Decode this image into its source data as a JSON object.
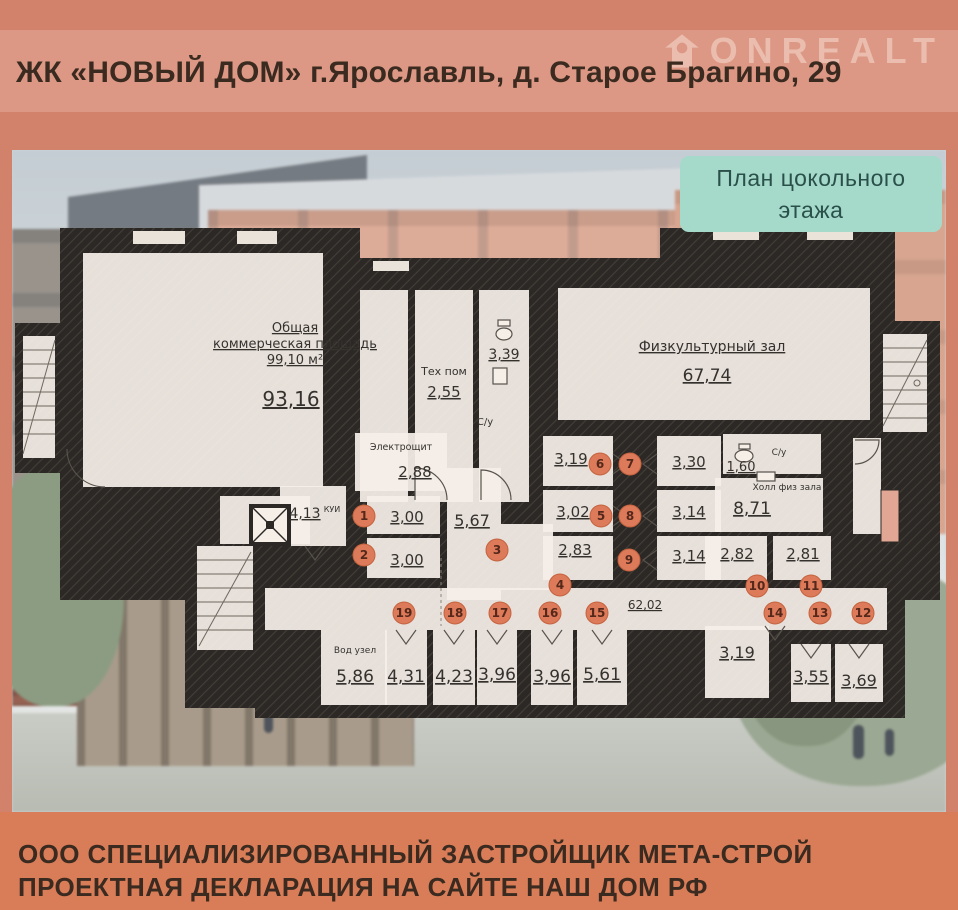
{
  "header": {
    "title": "ЖК «НОВЫЙ ДОМ» г.Ярославль, д. Старое Брагино, 29",
    "watermark": "ONREALT"
  },
  "badge": {
    "line1": "План цокольного",
    "line2": "этажа"
  },
  "footer": {
    "text": "ООО СПЕЦИАЛИЗИРОВАННЫЙ ЗАСТРОЙЩИК МЕТА-СТРОЙ ПРОЕКТНАЯ ДЕКЛАРАЦИЯ НА САЙТЕ НАШ ДОМ РФ"
  },
  "colors": {
    "background": "#d2826b",
    "footer_band": "#d87d58",
    "badge": "#a5dacb",
    "walls": "#2c2825",
    "room_fill": "#f5efe8",
    "marker": "#dd7a5a"
  },
  "rooms": {
    "commercial_name1": "Общая",
    "commercial_name2": "коммерческая площадь",
    "commercial_size": "99,10 м²",
    "commercial_area": "93,16",
    "tech_name": "Тех пом",
    "tech_area": "2,55",
    "wc1_area": "3,39",
    "wc1_name": "С/у",
    "gym_name": "Физкультурный зал",
    "gym_area": "67,74",
    "electro_name": "Электрощит",
    "electro_area": "2,88",
    "kui_area": "4,13",
    "kui_name": "КУИ",
    "r1": "3,00",
    "r2": "3,00",
    "hall1": "5,67",
    "r4": "2,83",
    "r5": "3,02",
    "r6": "3,19",
    "r7": "3,30",
    "r8": "3,14",
    "r9": "3,14",
    "wc2_area": "1,60",
    "wc2_name": "С/у",
    "hall2_name": "Холл физ зала",
    "hall2_area": "8,71",
    "r10": "2,82",
    "r11": "2,81",
    "vod_name": "Вод узел",
    "vod_area": "5,86",
    "r19": "4,31",
    "r18": "4,23",
    "r17": "3,96",
    "r16": "3,96",
    "r15": "5,61",
    "corridor_area": "62,02",
    "r14": "3,19",
    "r13": "3,55",
    "r12": "3,69"
  },
  "markers": {
    "m1": "1",
    "m2": "2",
    "m3": "3",
    "m4": "4",
    "m5": "5",
    "m6": "6",
    "m7": "7",
    "m8": "8",
    "m9": "9",
    "m10": "10",
    "m11": "11",
    "m12": "12",
    "m13": "13",
    "m14": "14",
    "m15": "15",
    "m16": "16",
    "m17": "17",
    "m18": "18",
    "m19": "19"
  }
}
